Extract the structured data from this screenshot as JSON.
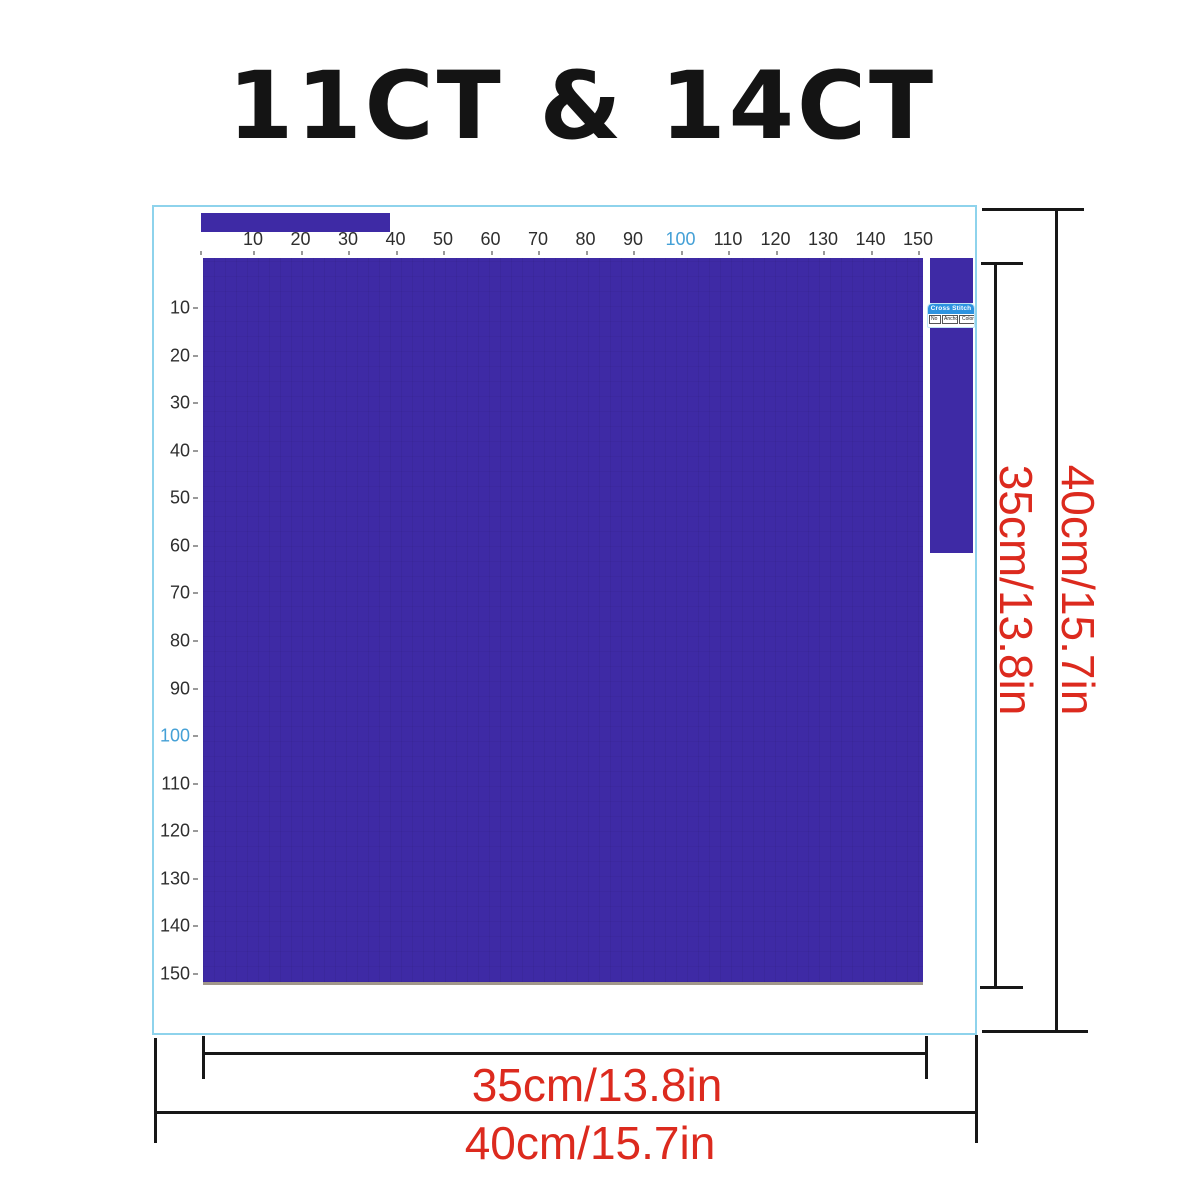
{
  "title": "11CT & 14CT",
  "colors": {
    "fabric_blue": "#3e2aa5",
    "border_blue": "#8ed3ec",
    "dimension_red": "#dc2a1e",
    "ruler_highlight": "#44a0d6",
    "label_header_blue": "#2d93e0"
  },
  "rulers": {
    "top": {
      "values": [
        10,
        20,
        30,
        40,
        50,
        60,
        70,
        80,
        90,
        100,
        110,
        120,
        130,
        140,
        150
      ],
      "highlighted": 100
    },
    "left": {
      "values": [
        10,
        20,
        30,
        40,
        50,
        60,
        70,
        80,
        90,
        100,
        110,
        120,
        130,
        140,
        150
      ],
      "highlighted": 100
    }
  },
  "stitch_label": {
    "header": "Cross Stitch",
    "columns": [
      "No",
      "Anchor",
      "Color"
    ]
  },
  "dimensions": {
    "fabric_width_label": "35cm/13.8in",
    "fabric_height_label": "35cm/13.8in",
    "total_width_label": "40cm/15.7in",
    "total_height_label": "40cm/15.7in"
  }
}
